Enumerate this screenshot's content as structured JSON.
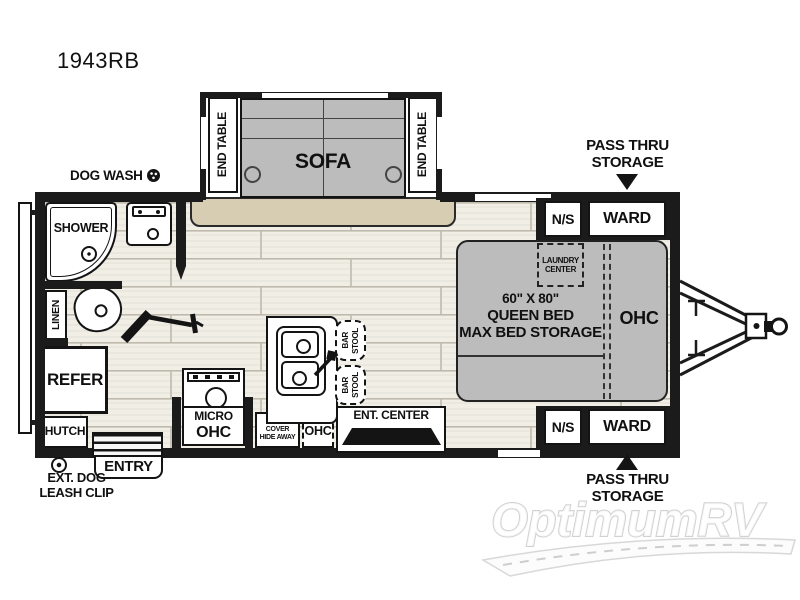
{
  "title": "1943RB",
  "colors": {
    "wall": "#1b1b1b",
    "furn": "#bcbcbc",
    "carpet": "#d6cdb3",
    "floor": "#f1eee6",
    "ink": "#111111"
  },
  "labels": {
    "dog_wash": "DOG WASH",
    "end_table": "END TABLE",
    "sofa": "SOFA",
    "shower": "SHOWER",
    "linen": "LINEN",
    "refer": "REFER",
    "hutch": "HUTCH",
    "entry": "ENTRY",
    "leash_line1": "EXT. DOG",
    "leash_line2": "LEASH CLIP",
    "micro_line1": "MICRO",
    "micro_line2": "OHC",
    "sink_cover_line1": "SINK",
    "sink_cover_line2": "COVER",
    "sink_cover_line3": "HIDE AWAY",
    "kitchen_ohc": "OHC",
    "bar": "BAR",
    "stool": "STOOL",
    "ent_center": "ENT. CENTER",
    "laundry_line1": "LAUNDRY",
    "laundry_line2": "CENTER",
    "bed_line1": "60\" X 80\"",
    "bed_line2": "QUEEN BED",
    "bed_line3": "MAX BED STORAGE",
    "bed_ohc": "OHC",
    "ns_top": "N/S",
    "ward_top": "WARD",
    "ns_bottom": "N/S",
    "ward_bottom": "WARD",
    "pass_thru_line1": "PASS THRU",
    "pass_thru_line2": "STORAGE",
    "watermark": "OptimumRV"
  }
}
